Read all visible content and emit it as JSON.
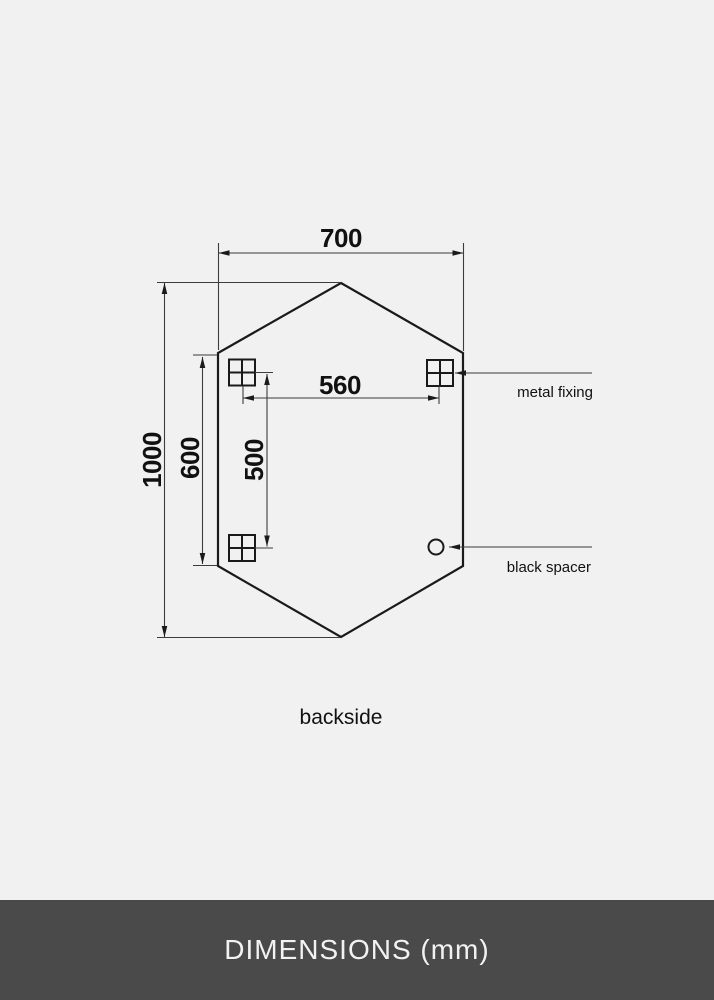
{
  "colors": {
    "background": "#f1f1f1",
    "drawing_line": "#1a1a1a",
    "dimension_line": "#3c3c3c",
    "footer_background": "#4a4a4a",
    "footer_text": "#f2f2f2"
  },
  "diagram": {
    "shape": "hexagonal mirror backside outline",
    "dimensions": {
      "width": {
        "value": "700"
      },
      "height": {
        "value": "1000"
      },
      "side_edge": {
        "value": "600"
      },
      "fixing_spacing_horizontal": {
        "value": "560"
      },
      "fixing_spacing_vertical": {
        "value": "500"
      }
    },
    "callouts": {
      "metal_fixing": "metal fixing",
      "black_spacer": "black spacer"
    },
    "view_label": "backside"
  },
  "footer": {
    "title": "DIMENSIONS (mm)"
  }
}
